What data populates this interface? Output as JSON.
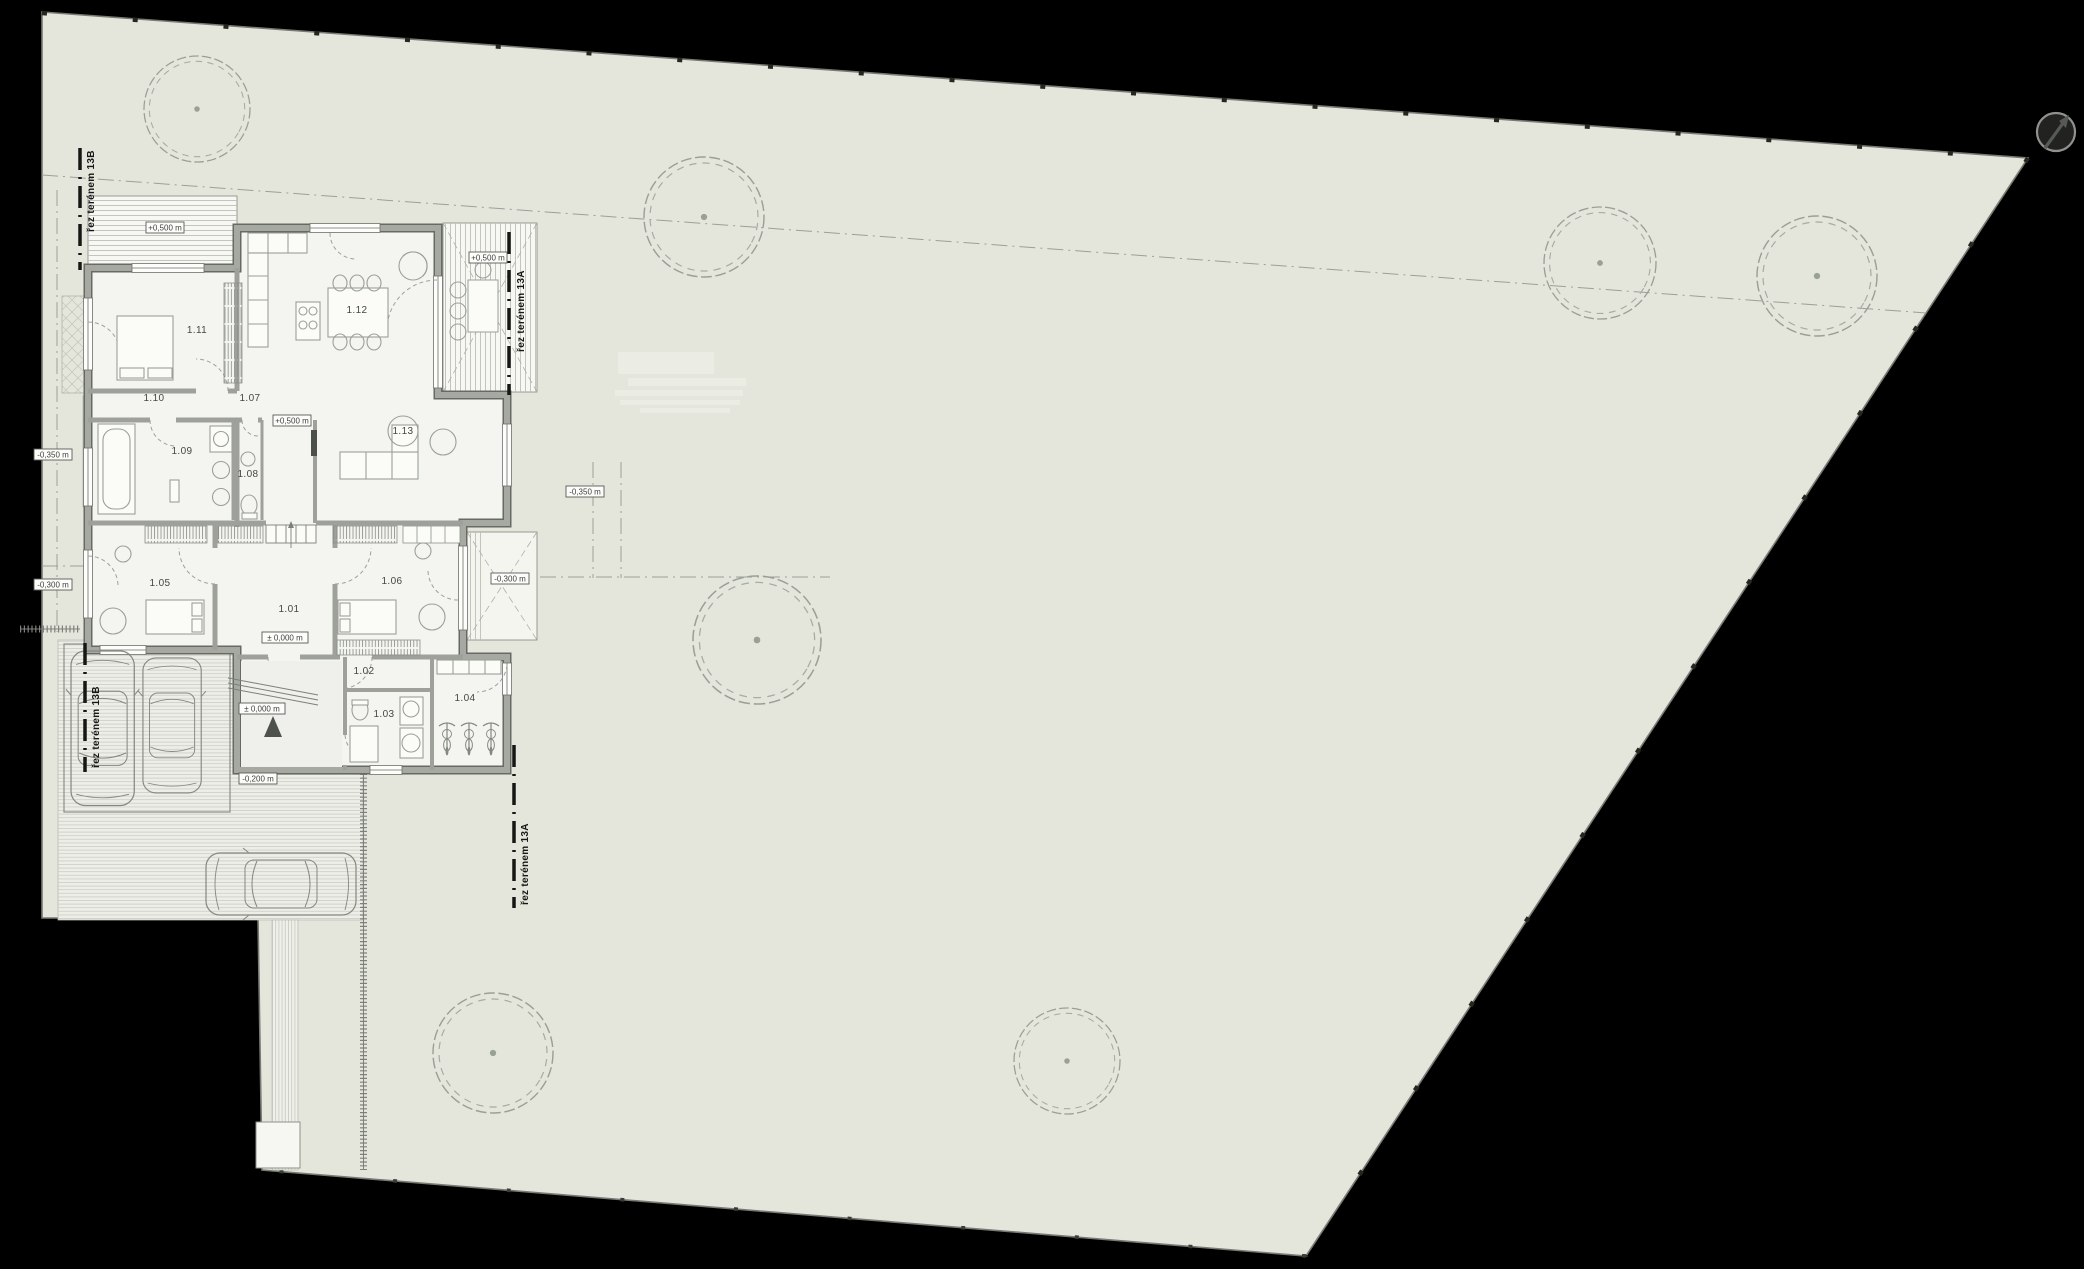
{
  "canvas": {
    "width": 2084,
    "height": 1269
  },
  "colors": {
    "background": "#000000",
    "site_fill": "#e4e6dc",
    "site_outline": "#777b74",
    "wall_fill": "#a5a9a2",
    "wall_edge": "#666a63",
    "floor": "#f4f5f1",
    "deck": "#f7f8f3",
    "paving": "#edeee7",
    "furniture_line": "#9aa098",
    "section_line": "#141714",
    "entrance_marker": "#4e524c"
  },
  "rooms": [
    {
      "id": "1.01"
    },
    {
      "id": "1.02"
    },
    {
      "id": "1.03"
    },
    {
      "id": "1.04"
    },
    {
      "id": "1.05"
    },
    {
      "id": "1.06"
    },
    {
      "id": "1.07"
    },
    {
      "id": "1.08"
    },
    {
      "id": "1.09"
    },
    {
      "id": "1.10"
    },
    {
      "id": "1.11"
    },
    {
      "id": "1.12"
    },
    {
      "id": "1.13"
    }
  ],
  "levels": {
    "deck_north": "+0,500 m",
    "deck_east": "+0,500 m",
    "corridor": "+0,500 m",
    "hall": "± 0,000 m",
    "entry": "± 0,000 m",
    "entry_exterior": "-0,200 m",
    "garden_east": "-0,300 m",
    "garden_west": "-0,300 m",
    "garden_west_mid": "-0,350 m",
    "garden_east_living": "-0,350 m"
  },
  "sections": {
    "a": "řez terénem 13A",
    "b": "řez terénem 13B"
  },
  "icons": {
    "north_arrow": "north-arrow",
    "tree": "tree-icon",
    "car": "car-icon",
    "bicycle": "bicycle-icon",
    "entrance": "entrance-triangle-icon"
  }
}
